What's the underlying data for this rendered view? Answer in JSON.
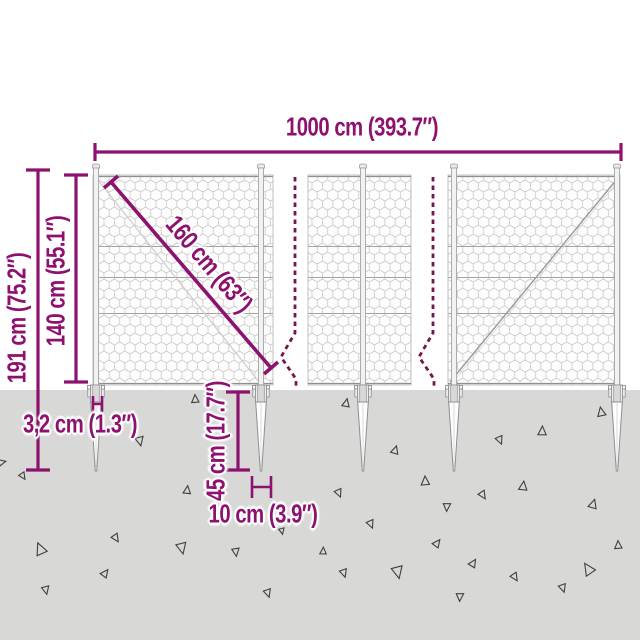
{
  "diagram": {
    "title": "wire mesh fence with spike anchors - dimension diagram",
    "dimensions": {
      "total_width": "1000 cm (393.7″)",
      "total_height": "191 cm (75.2″)",
      "fence_height": "140 cm (55.1″)",
      "mesh_diagonal": "160 cm (63″)",
      "post_width": "3,2 cm (1.3″)",
      "spike_depth": "45 cm (17.7″)",
      "spike_width": "10 cm (3.9″)"
    },
    "colors": {
      "dimension_purple": "#8d116f",
      "break_line": "#77164b",
      "ground_gray": "#d8d8d6",
      "mesh_gray": "#c8c8c8"
    }
  }
}
